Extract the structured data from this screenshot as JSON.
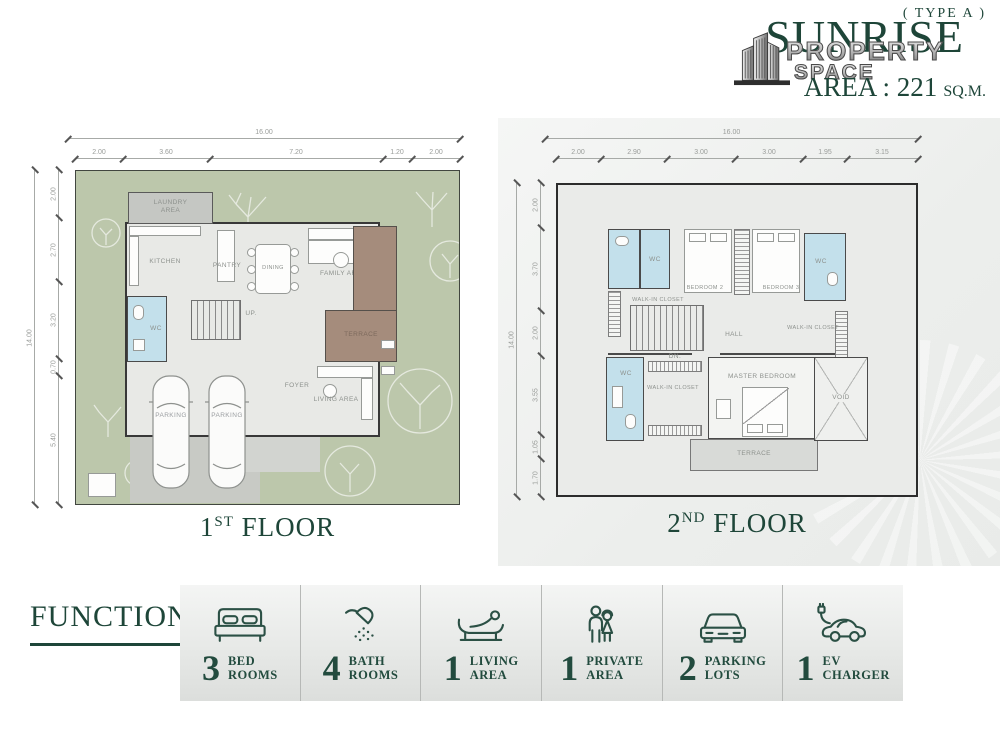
{
  "header": {
    "type_label": "( TYPE A )",
    "brand": "SUNRISE",
    "overlay_line1": "PROPERTY",
    "overlay_line2": "SPACE",
    "area_text": "AREA : 221",
    "area_unit": "SQ.M.",
    "logo_icon": "buildings-icon"
  },
  "floor1": {
    "title": {
      "num": "1",
      "sup": "ST",
      "word": " FLOOR"
    },
    "dims": {
      "top_total": "16.00",
      "top": [
        "2.00",
        "3.60",
        "7.20",
        "1.20",
        "2.00"
      ],
      "left_total": "14.00",
      "left": [
        "2.00",
        "2.70",
        "3.20",
        "0.70",
        "5.40"
      ]
    },
    "labels": {
      "laundry_1": "LAUNDRY",
      "laundry_2": "AREA",
      "kitchen": "KITCHEN",
      "pantry": "PANTRY",
      "dining": "DINING",
      "family": "FAMILY AREA",
      "terrace": "TERRACE",
      "wc": "WC",
      "stairs": "UP.",
      "foyer": "FOYER",
      "living": "LIVING AREA",
      "parking_left": "PARKING",
      "parking_right": "PARKING"
    }
  },
  "floor2": {
    "title": {
      "num": "2",
      "sup": "ND",
      "word": " FLOOR"
    },
    "dims": {
      "top_total": "16.00",
      "top": [
        "2.00",
        "2.90",
        "3.00",
        "3.00",
        "1.95",
        "3.15"
      ],
      "left_total": "14.00",
      "left": [
        "2.00",
        "3.70",
        "2.00",
        "3.55",
        "1.05",
        "1.70"
      ]
    },
    "labels": {
      "wc_top": "WC",
      "closet_top": "WALK-IN CLOSET",
      "bedroom2": "BEDROOM 2",
      "bedroom3": "BEDROOM 3",
      "wc_right": "WC",
      "closet_right": "WALK-IN CLOSET",
      "hall": "HALL",
      "stairs": "DN.",
      "wc_bottom": "WC",
      "closet_bottom": "WALK-IN CLOSET",
      "master": "MASTER BEDROOM",
      "terrace": "TERRACE",
      "void": "VOID"
    }
  },
  "function_bar": {
    "title": "FUNCTION",
    "items": [
      {
        "icon": "bed-icon",
        "count": "3",
        "label_1": "BED",
        "label_2": "ROOMS"
      },
      {
        "icon": "shower-icon",
        "count": "4",
        "label_1": "BATH",
        "label_2": "ROOMS"
      },
      {
        "icon": "lounge-icon",
        "count": "1",
        "label_1": "LIVING",
        "label_2": "AREA"
      },
      {
        "icon": "family-icon",
        "count": "1",
        "label_1": "PRIVATE",
        "label_2": "AREA"
      },
      {
        "icon": "car-icon",
        "count": "2",
        "label_1": "PARKING",
        "label_2": "LOTS"
      },
      {
        "icon": "ev-icon",
        "count": "1",
        "label_1": "EV",
        "label_2": "CHARGER"
      }
    ]
  },
  "colors": {
    "brand_green": "#1e4639",
    "garden_green": "#bcc7ab",
    "terrace_brown": "#a58c7c",
    "bathroom_blue": "#c3e0eb",
    "parking_gray": "#c8cac5",
    "floor_gray": "#e8e9e6"
  }
}
